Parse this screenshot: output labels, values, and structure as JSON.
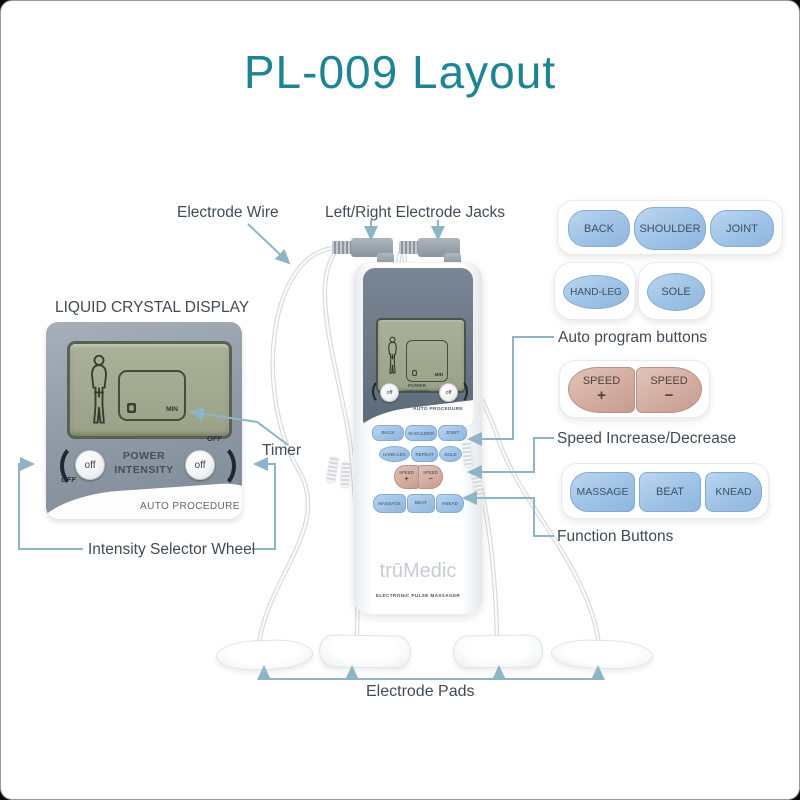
{
  "page": {
    "title": "PL-009 Layout"
  },
  "callouts": {
    "electrode_wire": "Electrode Wire",
    "electrode_jacks": "Left/Right Electrode Jacks",
    "lcd_title": "LIQUID CRYSTAL DISPLAY",
    "timer": "Timer",
    "intensity_wheel": "Intensity Selector Wheel",
    "auto_program": "Auto program buttons",
    "speed": "Speed Increase/Decrease",
    "function": "Function Buttons",
    "electrode_pads": "Electrode Pads"
  },
  "lcd_closeup": {
    "min": "MIN",
    "knob": "off",
    "off": "OFF",
    "power_line1": "POWER",
    "power_line2": "INTENSITY",
    "auto_procedure": "AUTO PROCEDURE"
  },
  "device": {
    "brand": "trūMedic",
    "tagline": "ELECTRONIC PULSE MASSAGER",
    "min": "MIN",
    "knob": "off",
    "power_line1": "POWER",
    "power_line2": "INTENSITY",
    "auto_procedure": "AUTO PROCEDURE",
    "buttons": {
      "row1": [
        "BACK",
        "SHOULDER",
        "JOINT"
      ],
      "row2": [
        "HAND-LEG",
        "REPEAT",
        "SOLE"
      ],
      "speed": {
        "label": "SPEED",
        "plus": "+",
        "minus": "−"
      },
      "row3": [
        "MASSAGE",
        "BEAT",
        "KNEAD"
      ]
    }
  },
  "button_groups": {
    "auto_row1": [
      "BACK",
      "SHOULDER",
      "JOINT"
    ],
    "auto_row2": [
      "HAND-LEG",
      "SOLE"
    ],
    "speed": {
      "label": "SPEED",
      "plus": "+",
      "minus": "−"
    },
    "function": [
      "MASSAGE",
      "BEAT",
      "KNEAD"
    ]
  },
  "colors": {
    "title_teal": "#1e8494",
    "callout_line": "#8db5c6",
    "label_text": "#414b55",
    "button_blue": "#a3c6e8",
    "button_pink": "#d2ab9f",
    "device_slate": "#5d6a79",
    "lcd_green": "#a2aa90"
  }
}
